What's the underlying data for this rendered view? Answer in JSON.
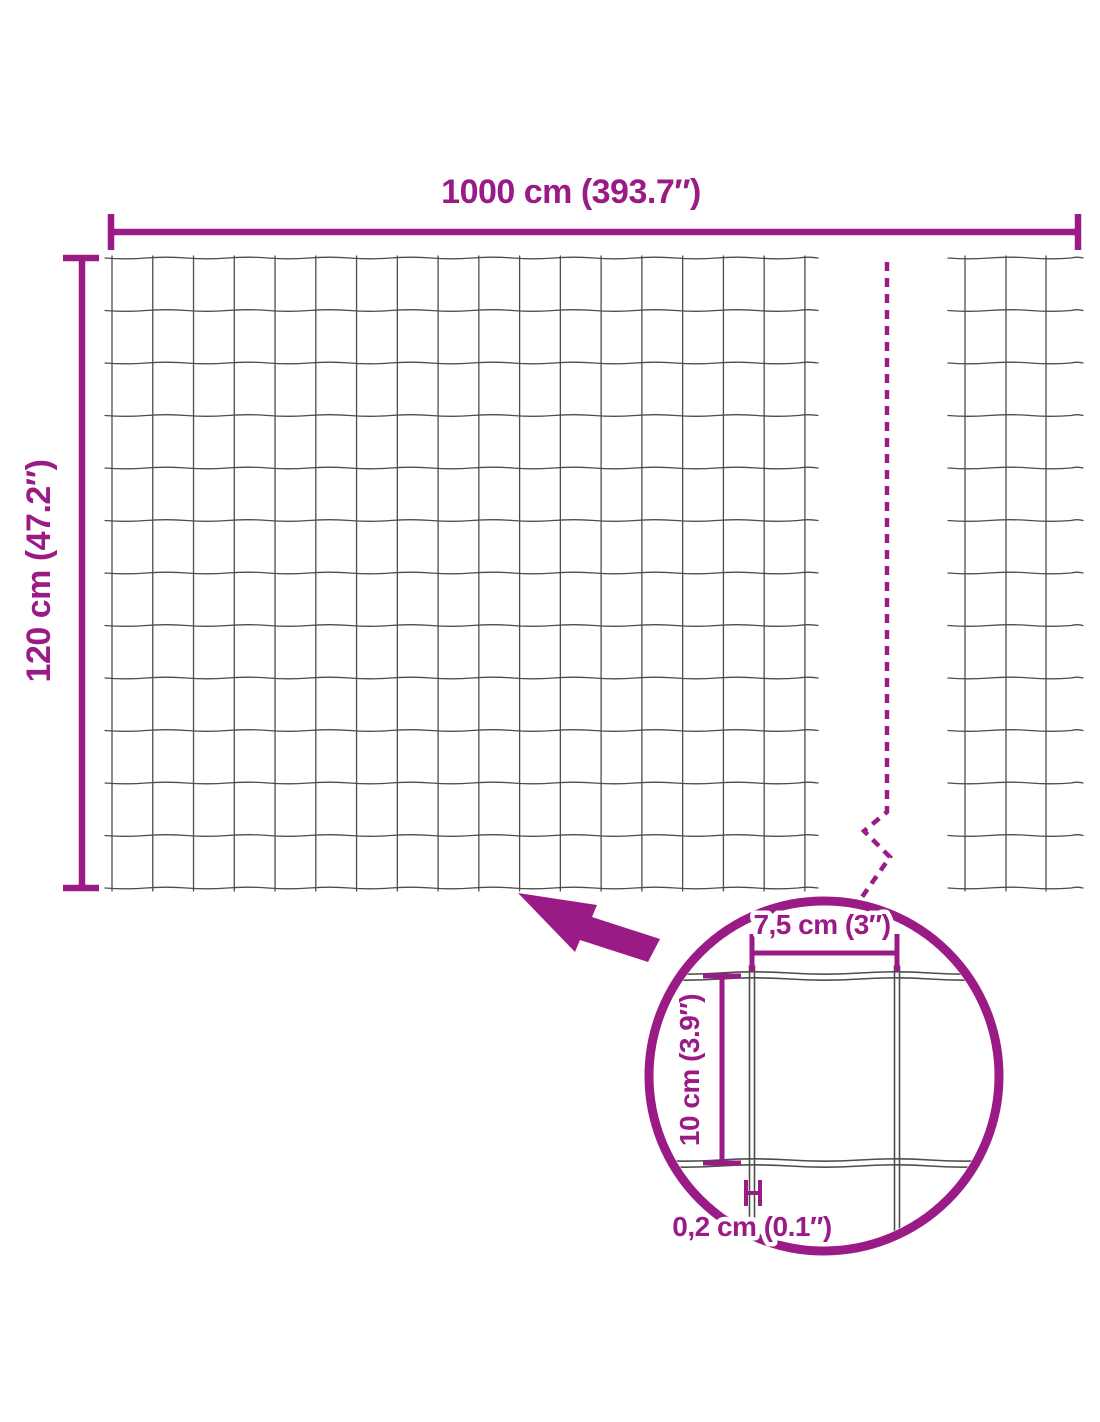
{
  "diagram": {
    "overall": {
      "width_label": "1000 cm (393.7″)",
      "height_label": "120 cm (47.2″)"
    },
    "detail": {
      "mesh_width_label": "7,5 cm (3″)",
      "mesh_height_label": "10 cm (3.9″)",
      "wire_thickness_label": "0,2 cm (0.1″)"
    },
    "colors": {
      "accent": "#9A1B86",
      "wire": "#4D4D4D",
      "background": "#FFFFFF"
    }
  }
}
